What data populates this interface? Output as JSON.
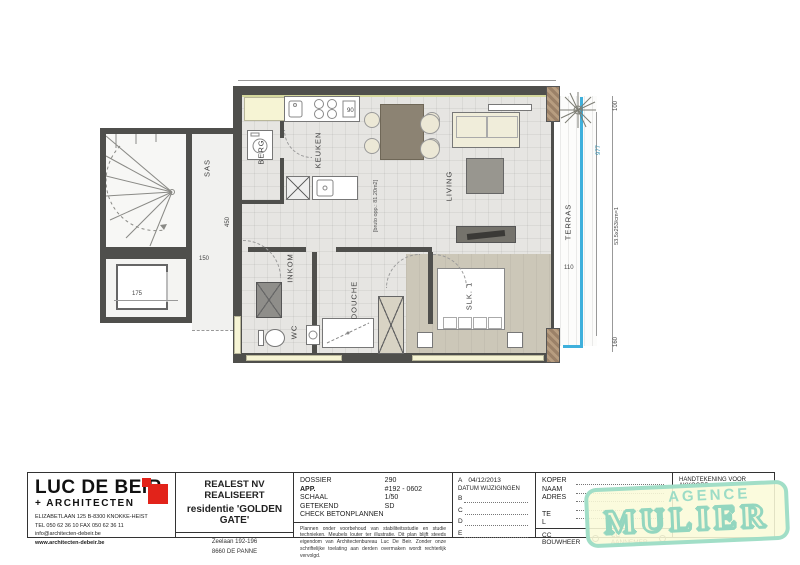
{
  "plan": {
    "rooms": {
      "sas": "SAS",
      "berg": "BERG",
      "keuken": "KEUKEN",
      "living": "LIVING",
      "terras": "TERRAS",
      "inkom": "INKOM",
      "wc": "WC",
      "douche": "DOUCHE",
      "slk1": "SLK. 1"
    },
    "dims": {
      "sas_height": "450",
      "sas_width": "150",
      "lift_width": "175",
      "kitchen": "90",
      "terras_width": "110",
      "terras_top": "100",
      "terras_bottom": "160",
      "terras_height": "977",
      "terras_note": "53.5x253/cm=1",
      "area_note": "[bruto opp.: 81.20m2]"
    }
  },
  "titleblock": {
    "architect": {
      "name": "LUC DE BEIR",
      "sub": "+ ARCHITECTEN",
      "address": "ELIZABETLAAN 125  B-8300 KNOKKE-HEIST",
      "tel": "TEL 050 62 36 10   FAX 050 62 36 11",
      "email": "info@architecten-debeir.be",
      "web": "www.architecten-debeir.be"
    },
    "project": {
      "line1": "REALEST NV",
      "line2": "REALISEERT",
      "line3": "residentie 'GOLDEN GATE'",
      "addr1": "Zeelaan 192-196",
      "addr2": "8660 DE PANNE"
    },
    "dossier": {
      "rows": [
        [
          "DOSSIER",
          "290"
        ],
        [
          "APP.",
          "#192 - 0602"
        ],
        [
          "SCHAAL",
          "1/50"
        ],
        [
          "GETEKEND",
          "SD"
        ]
      ],
      "check": "CHECK BETONPLANNEN",
      "disclaimer": "Plannen onder voorbehoud van stabiliteitsstudie en studie technieken. Meubels louter ter illustratie. Dit plan blijft steeds eigendom van Architectenbureau Luc De Beir. Zonder onze schriftelijke toelating aan derden overmaken wordt rechterlijk vervolgd."
    },
    "revisions": {
      "a_label": "A",
      "a_date": "04/12/2013",
      "header": "DATUM WIJZIGINGEN",
      "rows": [
        "B",
        "C",
        "D",
        "E"
      ]
    },
    "koper": {
      "labels": [
        "KOPER",
        "NAAM",
        "ADRES",
        "",
        "TE",
        "L"
      ],
      "cc1": "CC BOUWHEER",
      "cc2": "CC AANNEMER"
    },
    "signature": "HANDTEKENING VOOR AKKOORD",
    "stamp": {
      "line1": "AGENCE",
      "line2": "MULIER"
    }
  },
  "colors": {
    "accent_red": "#E2231A",
    "stamp_teal": "#9CDCC6",
    "stamp_bg": "#F8F8D8",
    "railing_cyan": "#3FB0DC",
    "wall_gray": "#4F4F4C"
  }
}
